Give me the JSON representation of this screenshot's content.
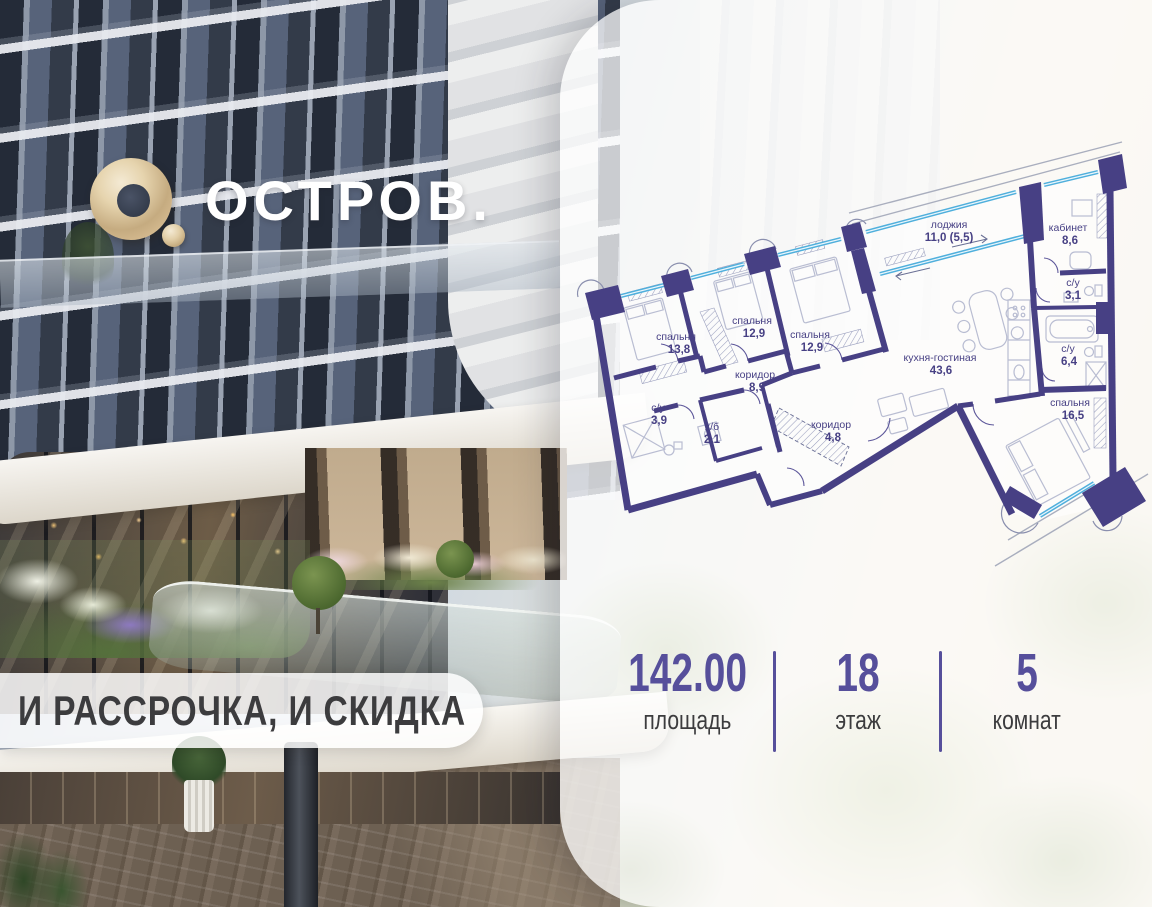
{
  "logo": {
    "brand": "ОСТРОВ."
  },
  "badge": {
    "text": "И РАССРОЧКА, И СКИДКА"
  },
  "stats": {
    "items": [
      {
        "value": "142.00",
        "label": "площадь"
      },
      {
        "value": "18",
        "label": "этаж"
      },
      {
        "value": "5",
        "label": "комнат"
      }
    ]
  },
  "floor_plan": {
    "rooms": [
      {
        "name": "спальня",
        "area": "13,8"
      },
      {
        "name": "спальня",
        "area": "12,9"
      },
      {
        "name": "спальня",
        "area": "12,9"
      },
      {
        "name": "коридор",
        "area": "8,9"
      },
      {
        "name": "с/у",
        "area": "3,9"
      },
      {
        "name": "х/б",
        "area": "2,1"
      },
      {
        "name": "коридор",
        "area": "4,8"
      },
      {
        "name": "лоджия",
        "area": "11,0 (5,5)"
      },
      {
        "name": "кабинет",
        "area": "8,6"
      },
      {
        "name": "с/у",
        "area": "3,1"
      },
      {
        "name": "с/у",
        "area": "6,4"
      },
      {
        "name": "кухня-гостиная",
        "area": "43,6"
      },
      {
        "name": "спальня",
        "area": "16,5"
      }
    ]
  },
  "colors": {
    "plan_wall": "#474084",
    "plan_window": "#4FAFDC",
    "accent_purple": "#564F9B",
    "brand_gold": "#D8BE93",
    "text_dark": "#3C3C3E"
  }
}
